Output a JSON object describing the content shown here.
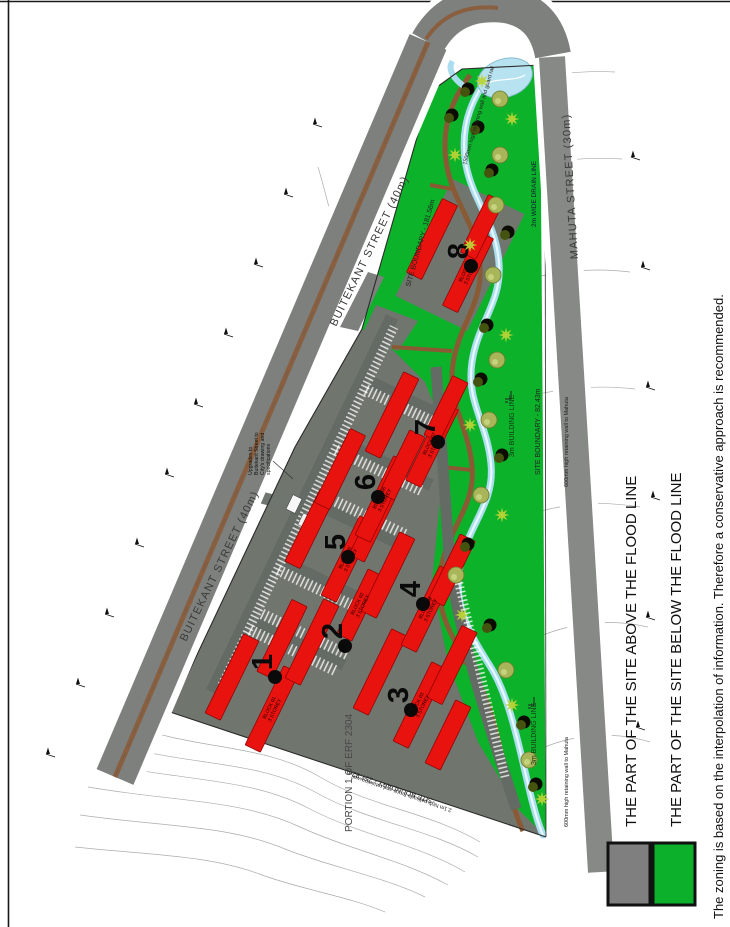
{
  "page": {
    "note": "The zoning is based on the interpolation of information.  Therefore a conservative approach is recommended."
  },
  "legend": {
    "above": {
      "label": "THE PART OF THE SITE ABOVE THE FLOOD LINE",
      "color": "#7F7F7F"
    },
    "below": {
      "label": "THE PART OF THE SITE BELOW THE FLOOD LINE",
      "color": "#0CB02A"
    }
  },
  "plan": {
    "streets": {
      "buitekant": "BUITEKANT STREET (40m)",
      "mahuta": "MAHUTA STREET (30m)"
    },
    "parcels": {
      "portion": "PORTION 1 OF ERF 2304"
    },
    "boundaries": {
      "ne": "SITE BOUNDARY - 181.56m",
      "se": "SITE BOUNDARY - 82.43m",
      "sw": "SITE BOUNDARY - 257.82m"
    },
    "building_lines": {
      "right": "3m BUILDING LINE",
      "lower": "3m BUILDING LINE"
    },
    "annotations": {
      "upgrade_note_lines": [
        "Upgrades to",
        "Buitekant Street to",
        "City's drawing and",
        "specifications"
      ],
      "retaining_wall_top": "1500mm high retaining wall and guard rail",
      "retaining_wall_right": "600mm high retaining wall to Mahuta",
      "retaining_wall_lower_right": "600mm high retaining wall to Mahuta",
      "palisade_note": "2.1m high palisade fence and retaining wall",
      "drain_line": "2m WIDE DRAIN LINE"
    },
    "blocks": [
      {
        "number": "1",
        "name": "BLOCK 01",
        "storeys": "3 STOREY"
      },
      {
        "number": "2",
        "name": "BLOCK 02",
        "storeys": "3 STOREY"
      },
      {
        "number": "3",
        "name": "BLOCK 03",
        "storeys": "3 STOREY"
      },
      {
        "number": "4",
        "name": "BLOCK 04",
        "storeys": "3 STOREY"
      },
      {
        "number": "5",
        "name": "BLOCK 05",
        "storeys": "3 STOREY"
      },
      {
        "number": "6",
        "name": "BLOCK 06",
        "storeys": "3 STOREY"
      },
      {
        "number": "7",
        "name": "BLOCK 07",
        "storeys": "3 STOREY"
      },
      {
        "number": "8",
        "name": "BLOCK 08",
        "storeys": "3 STOREY"
      }
    ]
  }
}
